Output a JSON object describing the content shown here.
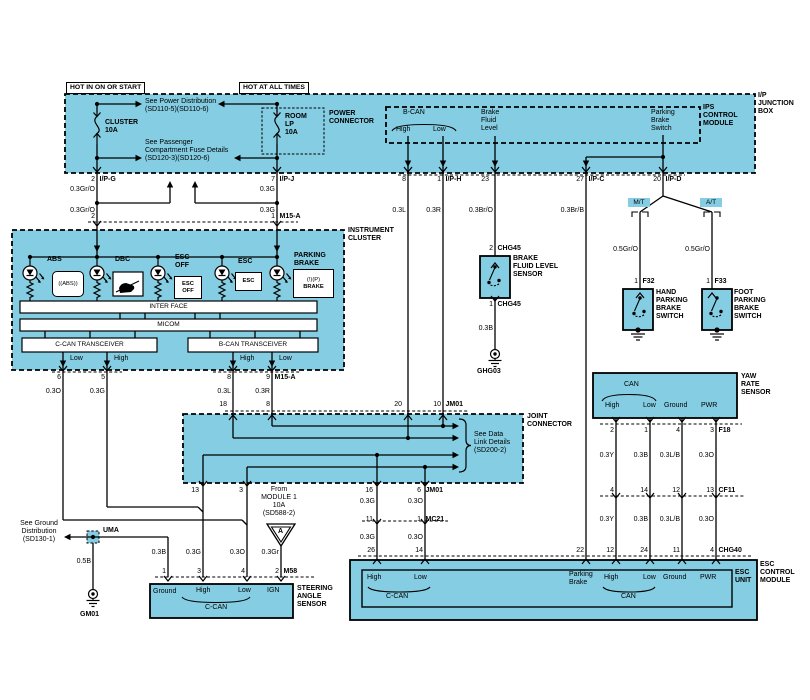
{
  "colors": {
    "module_fill": "#84CDE2",
    "line": "#000000",
    "background": "#FFFFFF"
  },
  "top": {
    "hot_start": "HOT IN ON OR START",
    "hot_all": "HOT AT ALL TIMES",
    "see_power": "See Power Distribution\n(SD110-5)(SD110-6)",
    "see_passenger": "See Passenger\nCompartment Fuse Details\n(SD120-3)(SD120-6)",
    "cluster_fuse": "CLUSTER\n10A",
    "room_fuse": "ROOM\nLP\n10A",
    "power_connector": "POWER\nCONNECTOR",
    "ips_module": "IPS\nCONTROL\nMODULE",
    "ip_junction_box": "I/P\nJUNCTION\nBOX",
    "bcan": "B-CAN",
    "bcan_high": "High",
    "bcan_low": "Low",
    "brake_fluid_level": "Brake\nFluid\nLevel",
    "parking_brake_switch": "Parking\nBrake\nSwitch",
    "pin_ipg_no": "2",
    "pin_ipg": "I/P-G",
    "pin_ipj_no": "7",
    "pin_ipj": "I/P-J",
    "pin_8": "8",
    "pin_iph_no": "1",
    "pin_iph": "I/P-H",
    "pin_23": "23",
    "pin_ipc_no": "27",
    "pin_ipc": "I/P-C",
    "pin_ipd_no": "20",
    "pin_ipd": "I/P-D"
  },
  "wires": {
    "gro1": "0.3Gr/O",
    "gro2": "0.3Gr/O",
    "g1": "0.3G",
    "g2": "0.3G",
    "l_ips": "0.3L",
    "r_ips": "0.3R",
    "bro": "0.3Br/O",
    "brb": "0.3Br/B",
    "o_cl": "0.3O",
    "g_cl": "0.3G",
    "l_cl": "0.3L",
    "r_cl": "0.3R",
    "g_jm": "0.3G",
    "o_jm": "0.3O",
    "g_mc": "0.3G",
    "o_mc": "0.3O",
    "b_m58": "0.3B",
    "g_m58": "0.3G",
    "o_m58": "0.3O",
    "gr_m58": "0.3Gr",
    "b5": "0.5B",
    "b_bfl": "0.3B",
    "gro_mt": "0.5Gr/O",
    "gro_at": "0.5Gr/O",
    "y1": "0.3Y",
    "b1": "0.3B",
    "lb1": "0.3L/B",
    "o1": "0.3O",
    "y2": "0.3Y",
    "b2": "0.3B",
    "lb2": "0.3L/B",
    "o2": "0.3O"
  },
  "cluster": {
    "title": "INSTRUMENT\nCLUSTER",
    "m15a_top_l": "2",
    "m15a_top_r": "1",
    "m15a_top": "M15-A",
    "abs": "ABS",
    "abs_icon": "((ABS))",
    "dbc": "DBC",
    "esc_off": "ESC\nOFF",
    "esc_off_icon": "ESC\nOFF",
    "esc": "ESC",
    "esc_icon": "ESC",
    "parking_brake": "PARKING\nBRAKE",
    "pb_icon_top": "(!)(P)",
    "pb_icon_bot": "BRAKE",
    "interface": "INTER FACE",
    "micom": "MICOM",
    "ccan_tr": "C-CAN TRANSCEIVER",
    "bcan_tr": "B-CAN TRANSCEIVER",
    "low1": "Low",
    "high1": "High",
    "high2": "High",
    "low2": "Low",
    "pin6": "6",
    "pin5": "5",
    "pin8": "8",
    "pin9": "9",
    "m15a_bot": "M15-A"
  },
  "joint": {
    "title": "JOINT\nCONNECTOR",
    "see_data": "See Data\nLink Details\n(SD200-2)",
    "p18": "18",
    "p8": "8",
    "p20": "20",
    "p10": "10",
    "jm01_t": "JM01",
    "p13": "13",
    "p3": "3",
    "p16": "16",
    "p6": "6",
    "jm01_b": "JM01"
  },
  "middle": {
    "from_module": "From\nMODULE 1\n10A\n(SD588-2)",
    "tri_a": "A",
    "mc21_p11": "11",
    "mc21_p1": "1",
    "mc21": "MC21"
  },
  "bfl": {
    "pin2": "2",
    "chg45_t": "CHG45",
    "pin1": "1",
    "chg45_b": "CHG45",
    "title": "BRAKE\nFLUID LEVEL\nSENSOR",
    "gnd": "GHG03"
  },
  "park": {
    "mt": "M/T",
    "at": "A/T",
    "f32_no": "1",
    "f32": "F32",
    "f33_no": "1",
    "f33": "F33",
    "hand": "HAND\nPARKING\nBRAKE\nSWITCH",
    "foot": "FOOT\nPARKING\nBRAKE\nSWITCH"
  },
  "gnd": {
    "see_ground": "See Ground\nDistribution\n(SD130-1)",
    "uma": "UMA",
    "gm01": "GM01"
  },
  "sas": {
    "p1": "1",
    "p3": "3",
    "p4": "4",
    "p2": "2",
    "m58": "M58",
    "ground": "Ground",
    "high": "High",
    "low": "Low",
    "ign": "IGN",
    "ccan": "C-CAN",
    "title": "STEERING\nANGLE\nSENSOR"
  },
  "yaw": {
    "title": "YAW\nRATE\nSENSOR",
    "can": "CAN",
    "high": "High",
    "low": "Low",
    "ground": "Ground",
    "pwr": "PWR",
    "p2": "2",
    "p1": "1",
    "p4": "4",
    "p3": "3",
    "f18": "F18",
    "c4": "4",
    "c14": "14",
    "c12": "12",
    "c13": "13",
    "cf11": "CF11"
  },
  "esc": {
    "p26": "26",
    "p14": "14",
    "p22": "22",
    "p12": "12",
    "p24": "24",
    "p11": "11",
    "p4": "4",
    "chg40": "CHG40",
    "high1": "High",
    "low1": "Low",
    "ccan": "C-CAN",
    "parking_brake": "Parking\nBrake",
    "high2": "High",
    "low2": "Low",
    "ground": "Ground",
    "pwr": "PWR",
    "can": "CAN",
    "unit": "ESC\nUNIT",
    "module": "ESC\nCONTROL\nMODULE"
  }
}
